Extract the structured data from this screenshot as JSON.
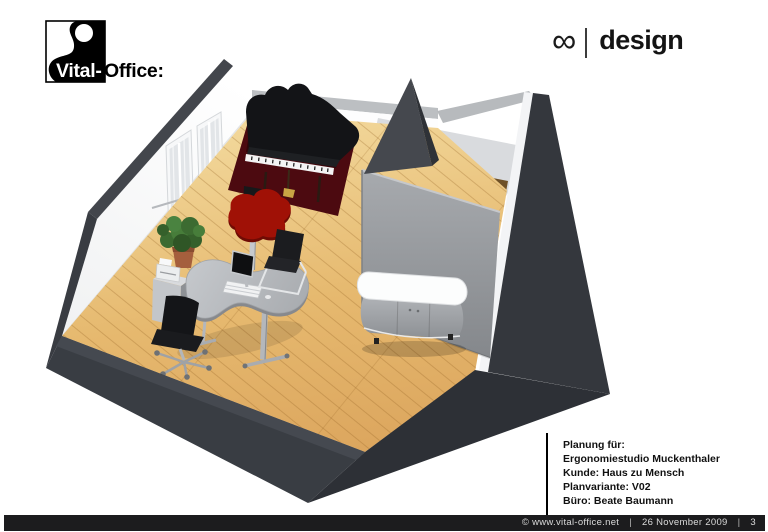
{
  "header": {
    "logo_left": {
      "brand_first": "Vital-",
      "brand_second": "Office:"
    },
    "logo_right": {
      "infinity": "∞",
      "separator": "|",
      "label": "design"
    }
  },
  "project_info": {
    "lines": [
      "Planung für:",
      "Ergonomiestudio Muckenthaler",
      "Kunde: Haus zu Mensch",
      "Planvariante: V02",
      "Büro: Beate Baumann"
    ]
  },
  "footer": {
    "copyright": "© www.vital-office.net",
    "separator": "|",
    "date": "26 November 2009",
    "page": "3"
  },
  "scene": {
    "description": "3D cutaway rendering of an attic office room (Ergonomiestudio) with beech wood floor",
    "objects": [
      "outer-walls",
      "left-wall-with-windows",
      "radiator",
      "grand-piano",
      "dark-red-rug",
      "piano-bench",
      "red-clover-table",
      "flatscreen-monitor",
      "kidney-shaped-desk",
      "keyboard",
      "office-swivel-chair",
      "cantilever-chair",
      "printer-stand",
      "potted-plant",
      "gray-partition-wall",
      "dark-sail-panel",
      "oval-sideboard",
      "hallway-wood-floor"
    ],
    "palette": {
      "wall_dark": "#36393f",
      "wall_top_band": "#43464c",
      "wall_cut_gray": "#bcbfc2",
      "floor_light": "#f3da9e",
      "floor_dark": "#dca65e",
      "rug_red": "#4c0a10",
      "piano_black": "#131417",
      "table_red": "#a01106",
      "desk_gray": "#b6b9bd",
      "partition_gray": "#9da0a4",
      "sideboard_top": "#fcfdfd",
      "plant_green": "#3f6f33",
      "hall_floor_brown": "#6e5027",
      "footer_bg": "#1c1c1e"
    }
  }
}
